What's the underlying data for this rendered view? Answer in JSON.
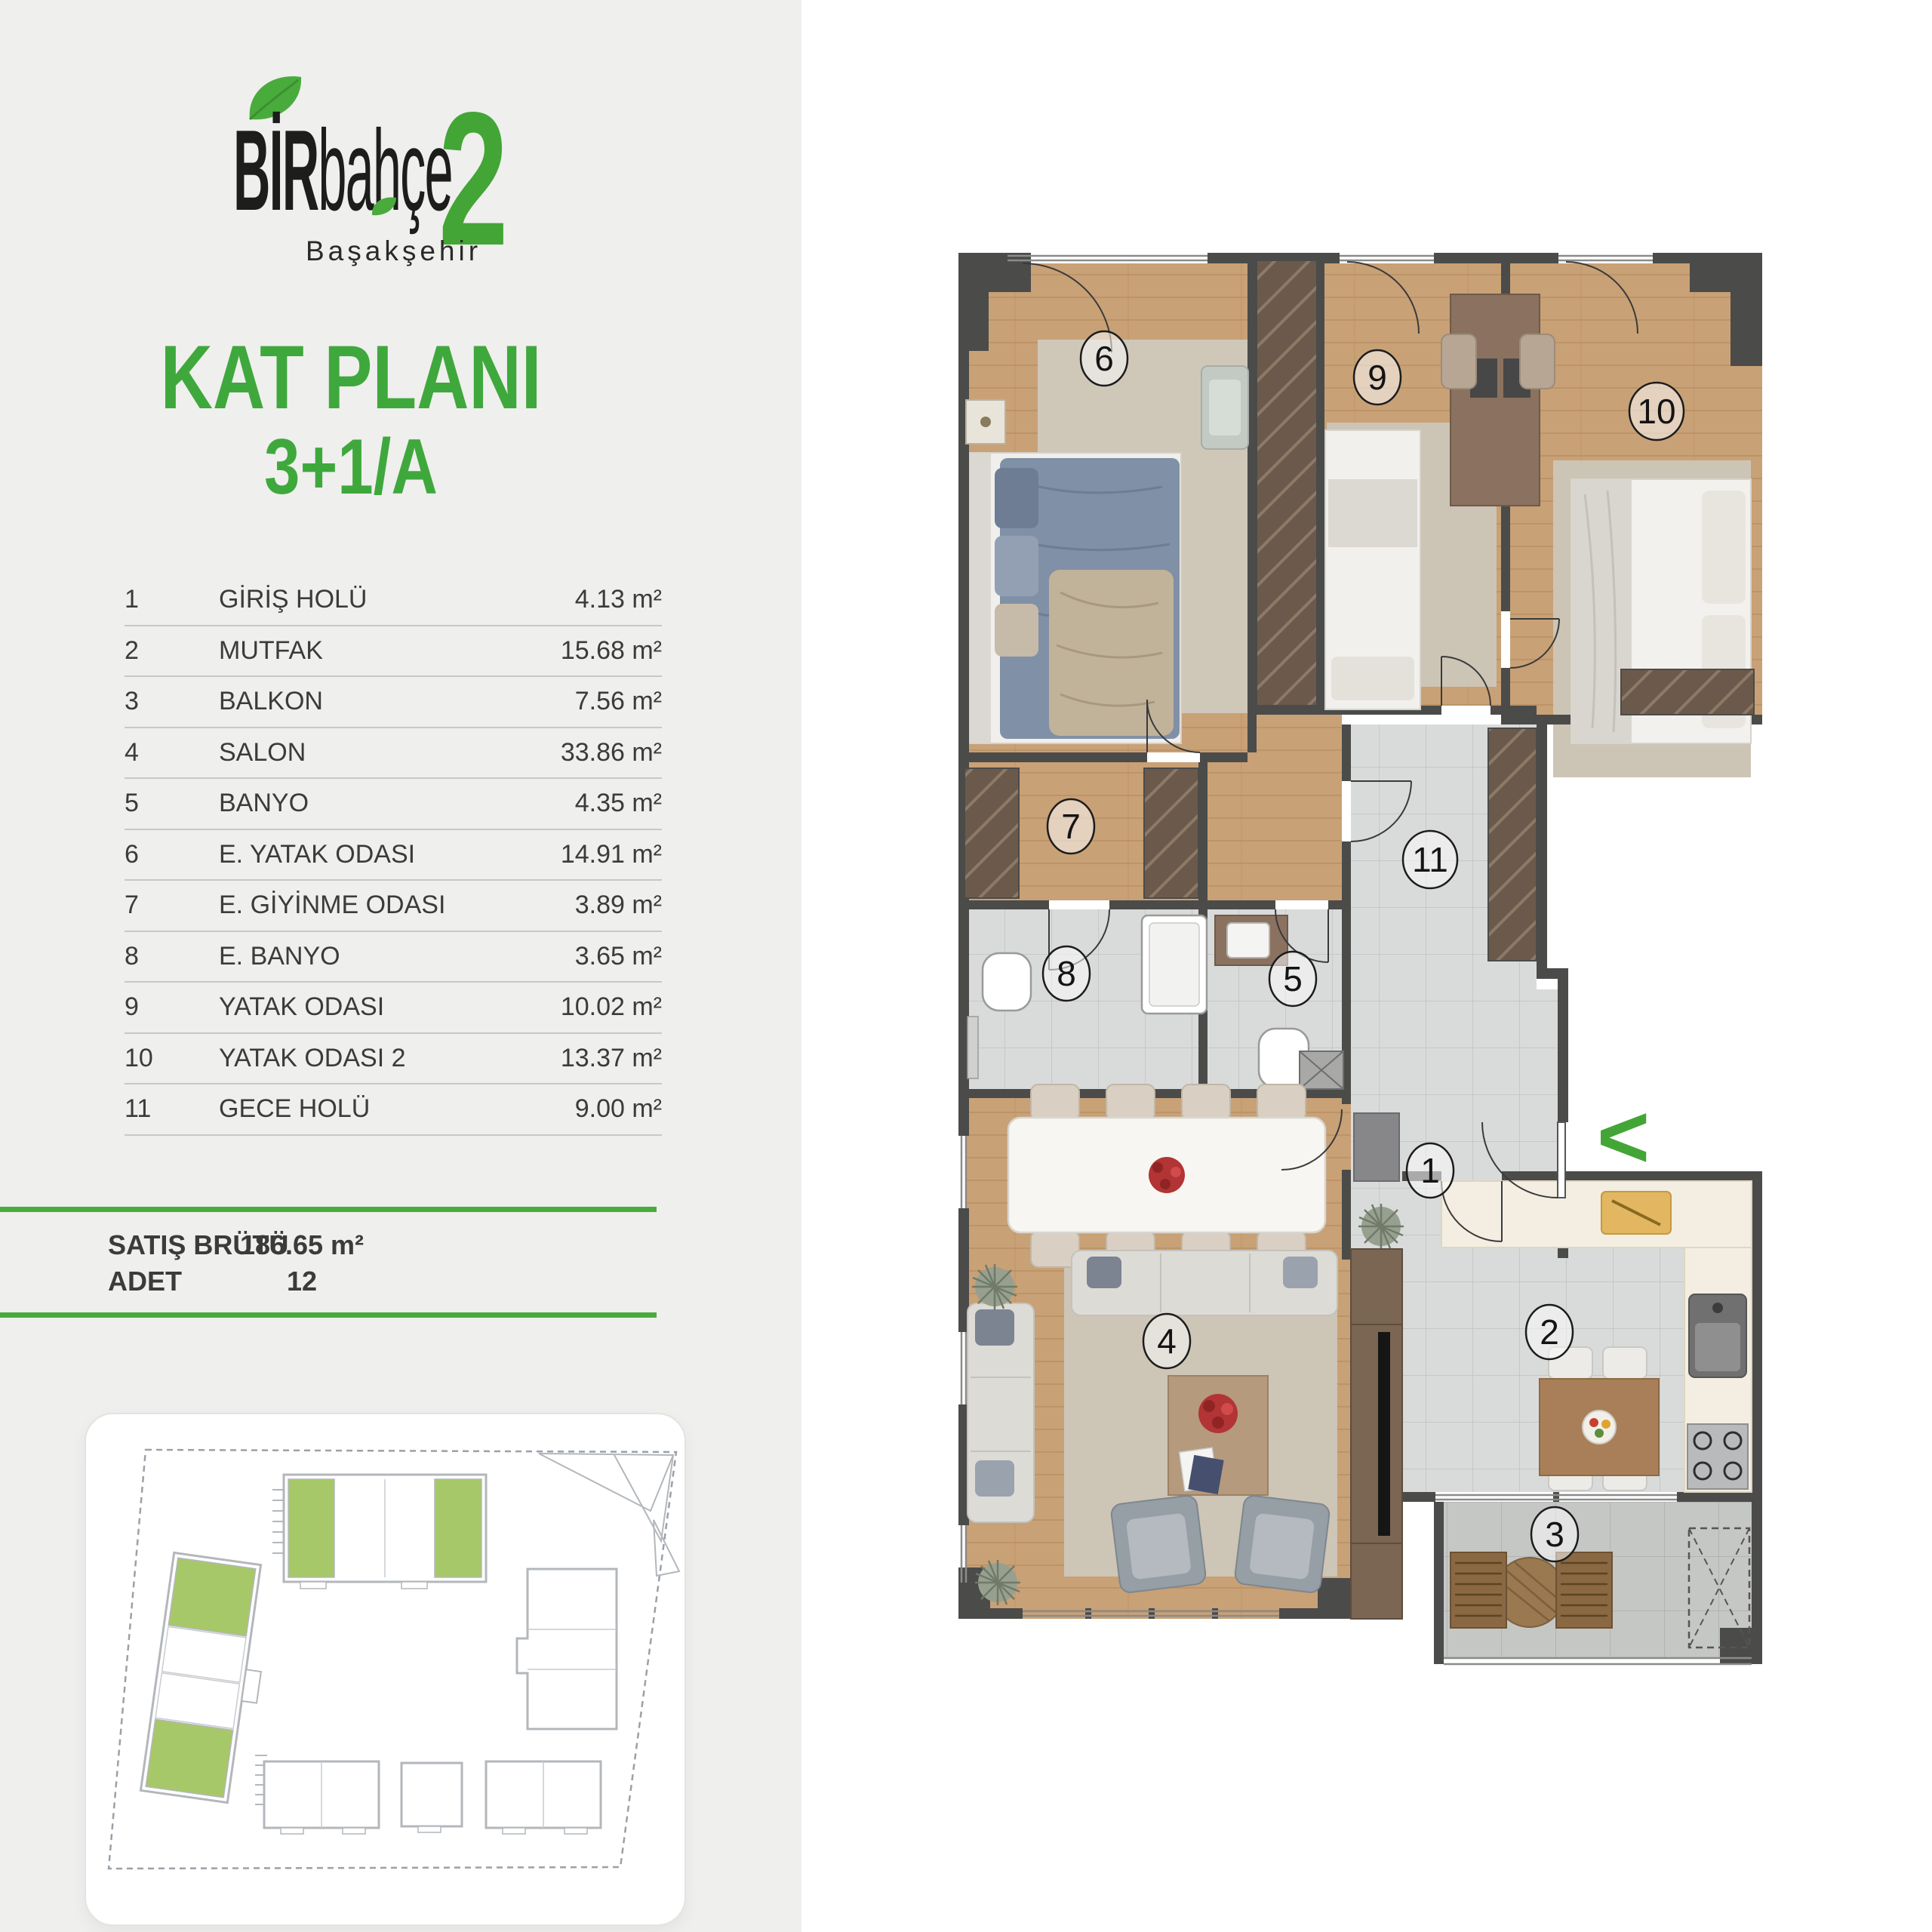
{
  "logo": {
    "brand_bold": "BİR",
    "brand_light": "bahçe",
    "number": "2",
    "subtitle": "Başakşehir",
    "accent": "#43a536",
    "ink": "#1d1d1b",
    "icons": [
      "leaf-icon"
    ]
  },
  "title": {
    "line1": "KAT PLANI",
    "line2": "3+1/A",
    "color": "#3fa83c"
  },
  "rooms": [
    {
      "no": "1",
      "name": "GİRİŞ HOLÜ",
      "area": "4.13 m²"
    },
    {
      "no": "2",
      "name": "MUTFAK",
      "area": "15.68 m²"
    },
    {
      "no": "3",
      "name": "BALKON",
      "area": "7.56 m²"
    },
    {
      "no": "4",
      "name": "SALON",
      "area": "33.86 m²"
    },
    {
      "no": "5",
      "name": "BANYO",
      "area": "4.35 m²"
    },
    {
      "no": "6",
      "name": "E. YATAK ODASI",
      "area": "14.91 m²"
    },
    {
      "no": "7",
      "name": "E. GİYİNME ODASI",
      "area": "3.89 m²"
    },
    {
      "no": "8",
      "name": "E. BANYO",
      "area": "3.65 m²"
    },
    {
      "no": "9",
      "name": "YATAK ODASI",
      "area": "10.02 m²"
    },
    {
      "no": "10",
      "name": "YATAK ODASI 2",
      "area": "13.37 m²"
    },
    {
      "no": "11",
      "name": "GECE HOLÜ",
      "area": "9.00 m²"
    }
  ],
  "summary": {
    "label1": "SATIŞ BRÜTÜ",
    "value1": "186.65 m²",
    "label2": "ADET",
    "value2": "12"
  },
  "floor_plan": {
    "room_numbers": [
      "1",
      "2",
      "3",
      "4",
      "5",
      "6",
      "7",
      "8",
      "9",
      "10",
      "11"
    ],
    "entry_marker": "<",
    "wall_color": "#4b4b4a",
    "wood_color": "#c9a176",
    "tile_color": "#d9dbda",
    "accent": "#43a536"
  },
  "site_plan": {
    "highlight": "#a6c868",
    "outline": "#b3b7bb",
    "boundary": "#9ba1a7"
  }
}
